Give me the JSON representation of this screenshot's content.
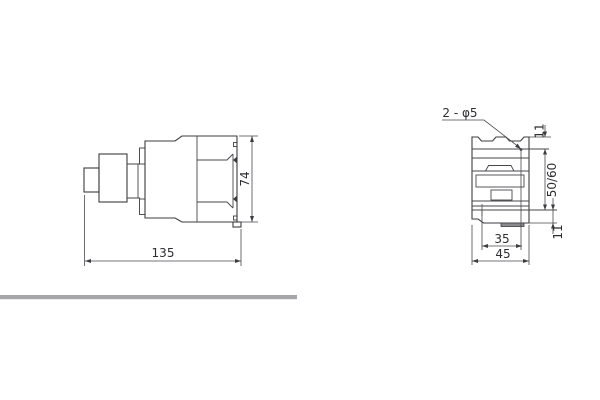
{
  "drawing": {
    "side_view": {
      "width_dim": "135",
      "height_dim": "74"
    },
    "front_view": {
      "holes_label": "2 - φ5",
      "top_margin_dim": "11",
      "vertical_pitch_dim": "50/60",
      "bottom_margin_dim": "11",
      "horizontal_pitch_dim": "35",
      "width_dim": "45"
    },
    "colors": {
      "line": "#3d3d41",
      "dimension_line": "#4a4a4e",
      "divider_bar": "#a6a6aa",
      "background": "#ffffff"
    }
  }
}
